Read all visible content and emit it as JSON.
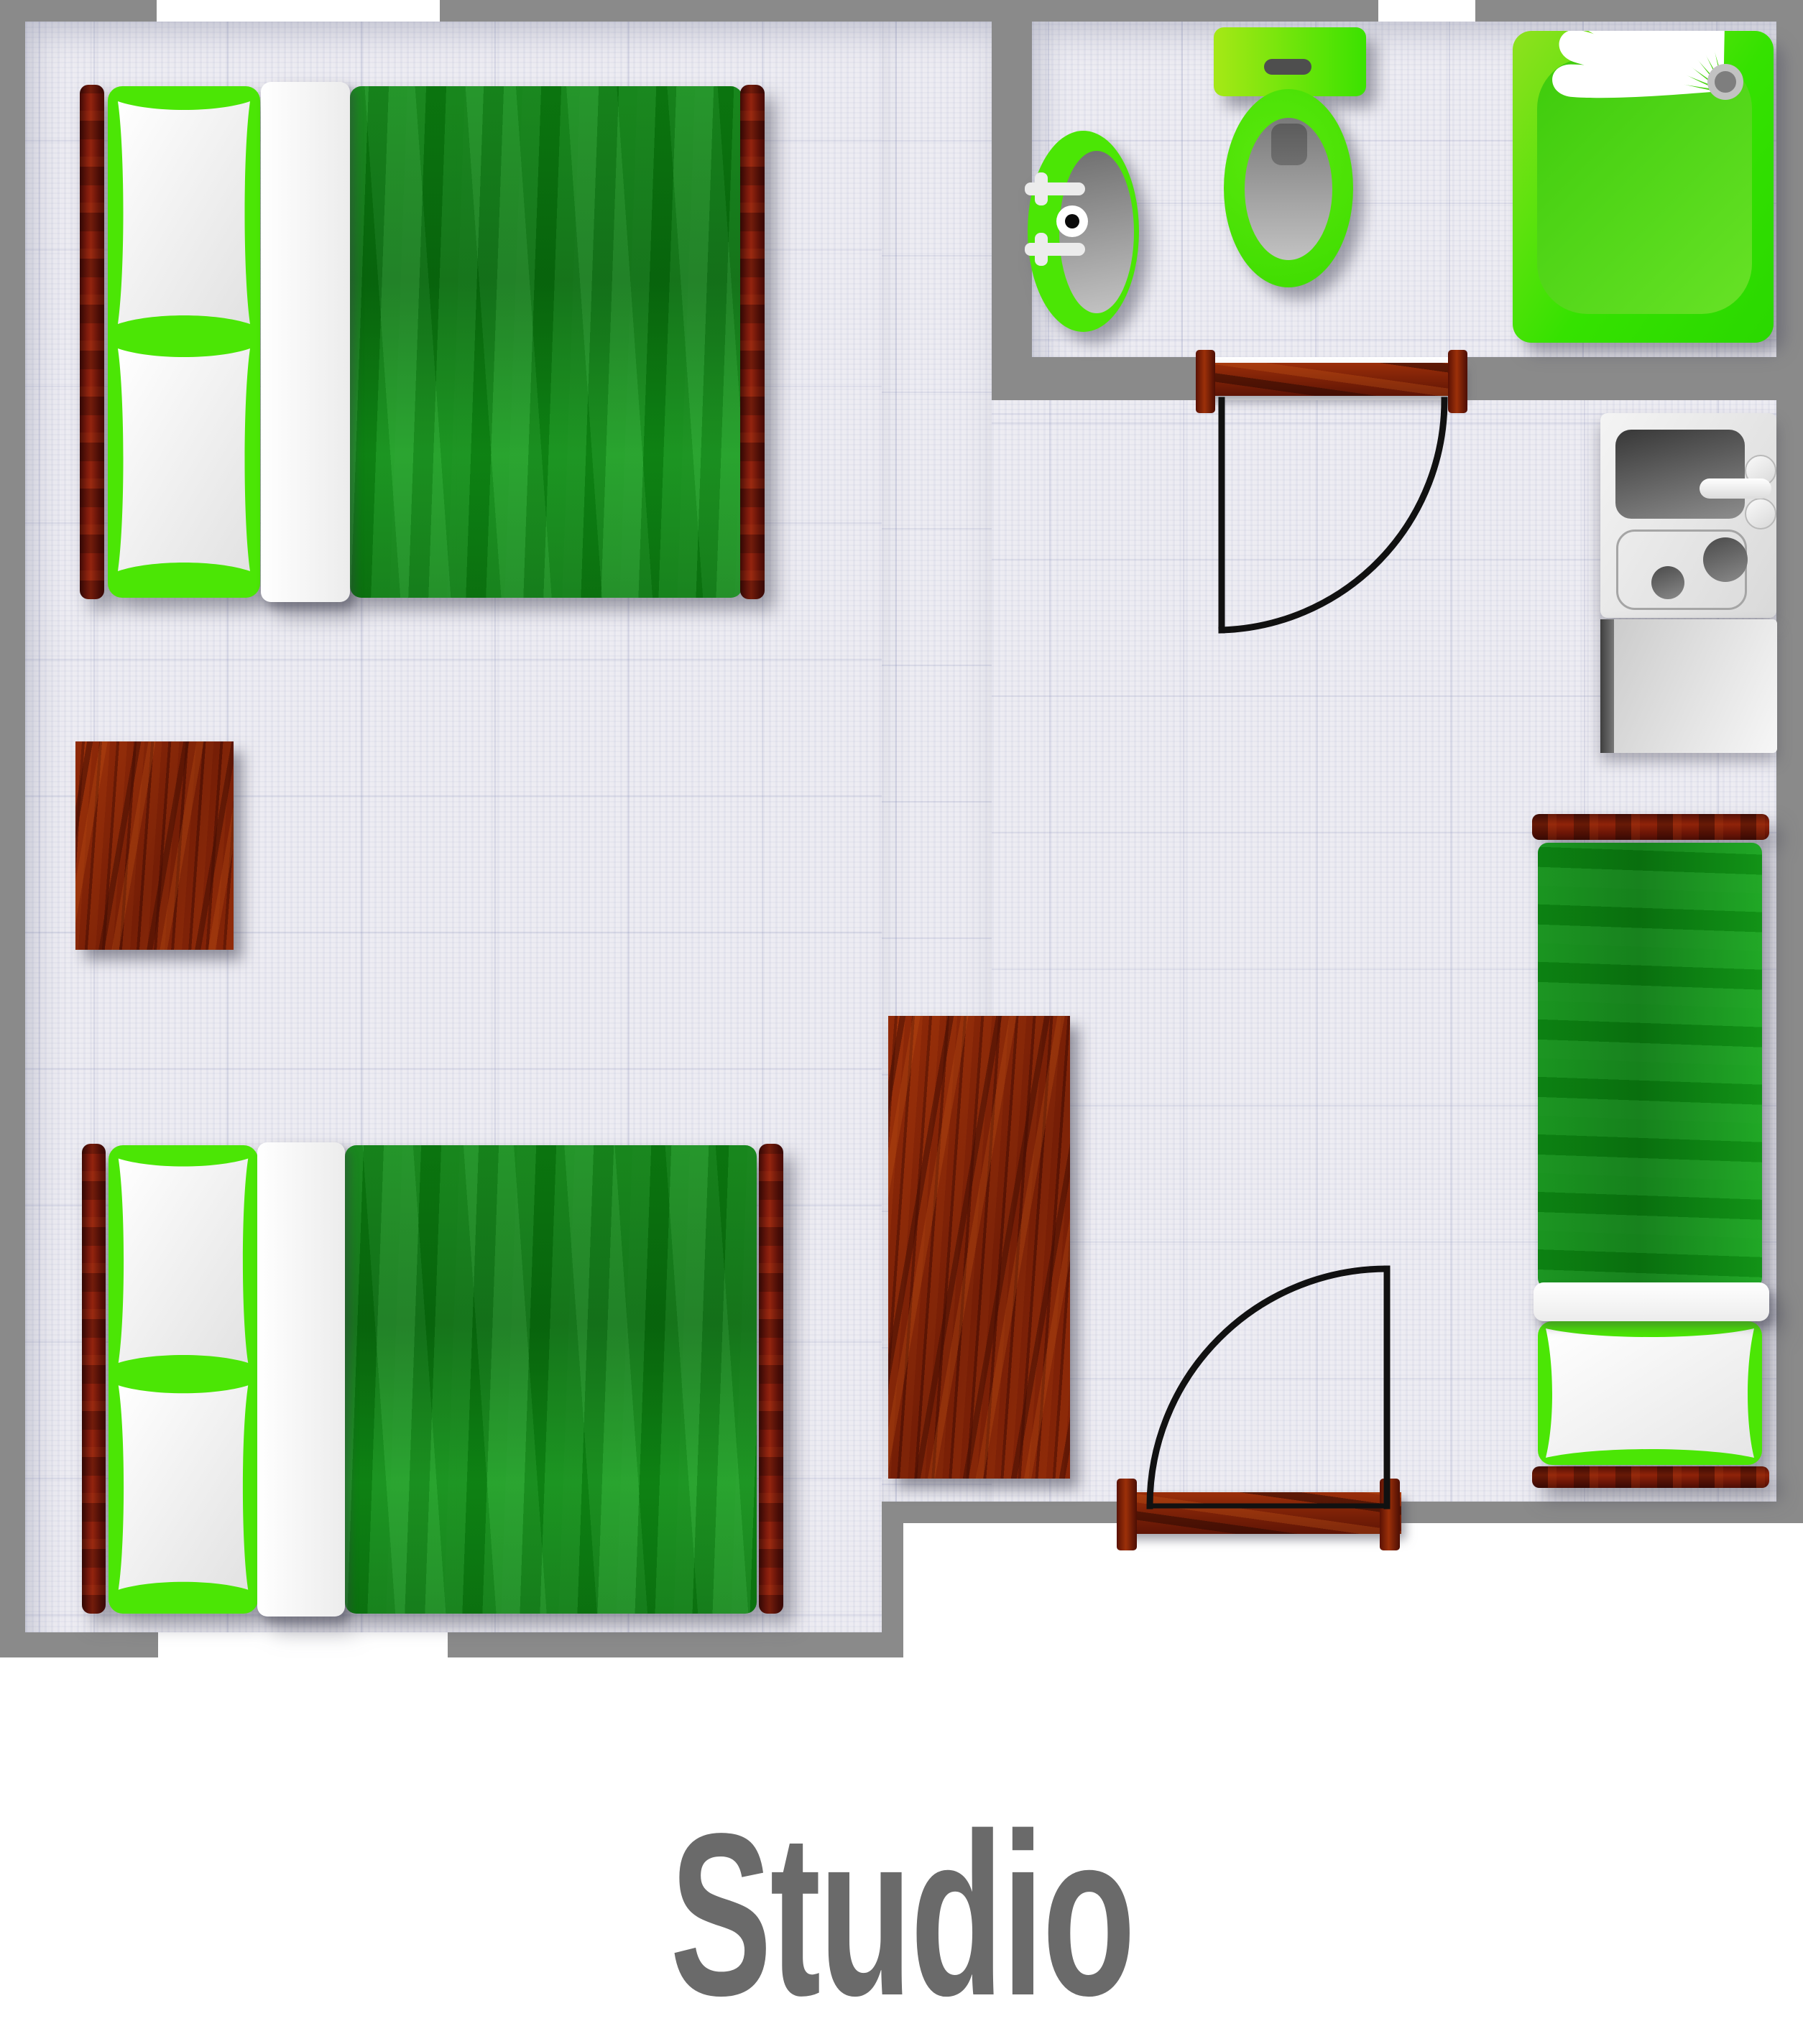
{
  "title": {
    "label": "Studio"
  },
  "plan": {
    "rooms": [
      {
        "name": "main-room"
      },
      {
        "name": "bathroom"
      }
    ],
    "objects": [
      "double-bed-top-left",
      "double-bed-bottom-left",
      "single-bed-right",
      "nightstand",
      "wardrobe",
      "kitchenette-sink-stove",
      "kitchenette-counter",
      "bathroom-sink",
      "toilet",
      "shower-tray",
      "bathroom-door",
      "entry-door",
      "window-top",
      "window-bathroom",
      "window-bottom"
    ]
  },
  "palette": {
    "wall": "#8a8a8a",
    "floor": "#edecf2",
    "lime": "#4be605",
    "blanket": "#0d8a13",
    "wood": "#8e2508",
    "bedpost": "#5e1008",
    "fixture_gray": "#9a9a9a",
    "door_line": "#111111",
    "title": "#6a6a6a",
    "outside": "#ffffff"
  }
}
